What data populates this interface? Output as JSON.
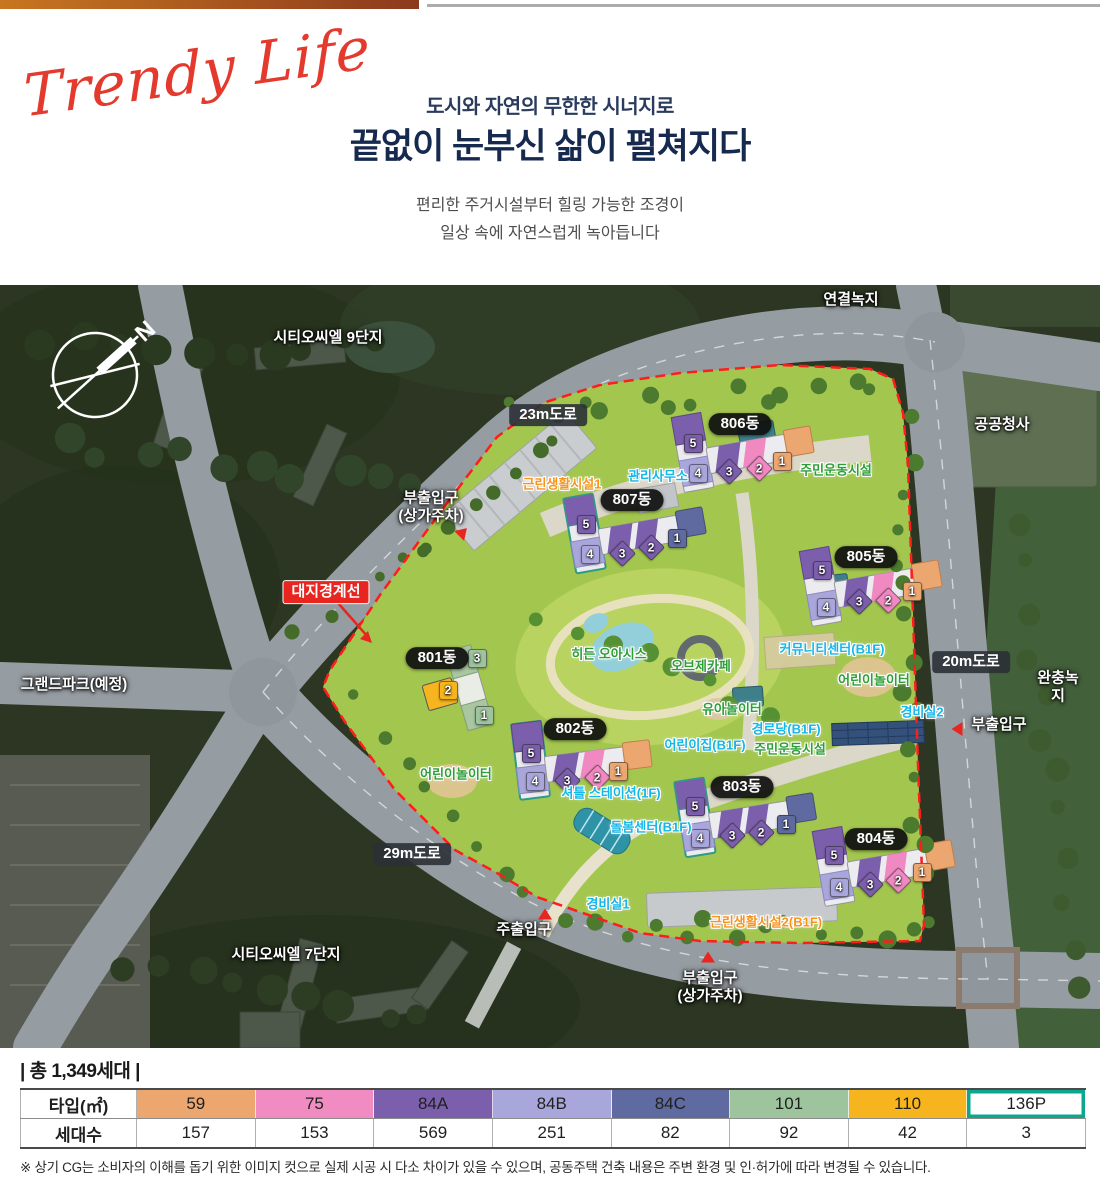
{
  "header": {
    "logo": "Trendy Life",
    "subtitle": "도시와 자연의 무한한 시너지로",
    "title": "끝없이 눈부신 삶이 펼쳐지다",
    "desc": "편리한 주거시설부터 힐링 가능한 조경이\n일상 속에 자연스럽게 녹아듭니다"
  },
  "map": {
    "compass_n": "N",
    "labels": [
      {
        "text": "연결녹지",
        "x": 851,
        "y": 15,
        "t": "w"
      },
      {
        "text": "시티오씨엘 9단지",
        "x": 328,
        "y": 53,
        "t": "w"
      },
      {
        "text": "공공청사",
        "x": 1002,
        "y": 140,
        "t": "w"
      },
      {
        "text": "완충녹지",
        "x": 1058,
        "y": 402,
        "t": "w"
      },
      {
        "text": "그랜드파크(예정)",
        "x": 74,
        "y": 400,
        "t": "w"
      },
      {
        "text": "시티오씨엘 7단지",
        "x": 286,
        "y": 670,
        "t": "w"
      },
      {
        "text": "부출입구\n(상가주차)",
        "x": 431,
        "y": 222,
        "t": "w"
      },
      {
        "text": "부출입구",
        "x": 999,
        "y": 440,
        "t": "w"
      },
      {
        "text": "부출입구\n(상가주차)",
        "x": 710,
        "y": 702,
        "t": "w"
      },
      {
        "text": "주출입구",
        "x": 524,
        "y": 645,
        "t": "w"
      },
      {
        "text": "23m도로",
        "x": 548,
        "y": 130,
        "t": "road"
      },
      {
        "text": "29m도로",
        "x": 412,
        "y": 569,
        "t": "road"
      },
      {
        "text": "20m도로",
        "x": 971,
        "y": 377,
        "t": "road"
      },
      {
        "text": "대지경계선",
        "x": 326,
        "y": 307,
        "t": "red"
      },
      {
        "text": "근린생활시설1",
        "x": 562,
        "y": 199,
        "t": "or"
      },
      {
        "text": "근린생활시설2(B1F)",
        "x": 766,
        "y": 637,
        "t": "or"
      },
      {
        "text": "관리사무소",
        "x": 658,
        "y": 191,
        "t": "cy"
      },
      {
        "text": "커뮤니티센터(B1F)",
        "x": 832,
        "y": 364,
        "t": "cy"
      },
      {
        "text": "경비실2",
        "x": 922,
        "y": 427,
        "t": "cy"
      },
      {
        "text": "경비실1",
        "x": 608,
        "y": 619,
        "t": "cy"
      },
      {
        "text": "경로당(B1F)",
        "x": 786,
        "y": 444,
        "t": "cy"
      },
      {
        "text": "어린이집(B1F)",
        "x": 705,
        "y": 460,
        "t": "cy"
      },
      {
        "text": "셔틀 스테이션(1F)",
        "x": 611,
        "y": 508,
        "t": "cy"
      },
      {
        "text": "돌봄센터(B1F)",
        "x": 651,
        "y": 542,
        "t": "cy"
      },
      {
        "text": "주민운동시설",
        "x": 836,
        "y": 185,
        "t": "gr"
      },
      {
        "text": "주민운동시설",
        "x": 790,
        "y": 464,
        "t": "gr"
      },
      {
        "text": "어린이놀이터",
        "x": 874,
        "y": 395,
        "t": "gr"
      },
      {
        "text": "어린이놀이터",
        "x": 456,
        "y": 489,
        "t": "gr"
      },
      {
        "text": "히든 오아시스",
        "x": 609,
        "y": 369,
        "t": "gr"
      },
      {
        "text": "오브제카페",
        "x": 701,
        "y": 381,
        "t": "gr"
      },
      {
        "text": "유아놀이터",
        "x": 732,
        "y": 424,
        "t": "gr"
      }
    ],
    "dong_pills": [
      {
        "text": "801동",
        "x": 437,
        "y": 373
      },
      {
        "text": "802동",
        "x": 575,
        "y": 444
      },
      {
        "text": "803동",
        "x": 742,
        "y": 502
      },
      {
        "text": "804동",
        "x": 876,
        "y": 554
      },
      {
        "text": "805동",
        "x": 866,
        "y": 272
      },
      {
        "text": "806동",
        "x": 740,
        "y": 139
      },
      {
        "text": "807동",
        "x": 632,
        "y": 215
      }
    ],
    "unit_badges": [
      {
        "b": "801",
        "n": "3",
        "x": 476,
        "y": 372,
        "c": "#9DC49C",
        "s": "s"
      },
      {
        "b": "801",
        "n": "2",
        "x": 447,
        "y": 404,
        "c": "#F6B51E",
        "s": "s"
      },
      {
        "b": "801",
        "n": "1",
        "x": 483,
        "y": 429,
        "c": "#9DC49C",
        "s": "s"
      },
      {
        "b": "802",
        "n": "5",
        "x": 530,
        "y": 467,
        "c": "#7C5FAC",
        "s": "s"
      },
      {
        "b": "802",
        "n": "4",
        "x": 534,
        "y": 495,
        "c": "#A9A6DB",
        "s": "s"
      },
      {
        "b": "802",
        "n": "3",
        "x": 566,
        "y": 494,
        "c": "#7C5FAC",
        "s": "d"
      },
      {
        "b": "802",
        "n": "2",
        "x": 596,
        "y": 491,
        "c": "#F089C2",
        "s": "d"
      },
      {
        "b": "802",
        "n": "1",
        "x": 617,
        "y": 485,
        "c": "#ECA771",
        "s": "s"
      },
      {
        "b": "803",
        "n": "5",
        "x": 694,
        "y": 520,
        "c": "#7C5FAC",
        "s": "s"
      },
      {
        "b": "803",
        "n": "4",
        "x": 699,
        "y": 552,
        "c": "#A9A6DB",
        "s": "s"
      },
      {
        "b": "803",
        "n": "3",
        "x": 731,
        "y": 549,
        "c": "#7C5FAC",
        "s": "d"
      },
      {
        "b": "803",
        "n": "2",
        "x": 760,
        "y": 546,
        "c": "#7C5FAC",
        "s": "d"
      },
      {
        "b": "803",
        "n": "1",
        "x": 785,
        "y": 538,
        "c": "#5F6BA0",
        "s": "s"
      },
      {
        "b": "804",
        "n": "5",
        "x": 833,
        "y": 569,
        "c": "#7C5FAC",
        "s": "s"
      },
      {
        "b": "804",
        "n": "4",
        "x": 838,
        "y": 601,
        "c": "#A9A6DB",
        "s": "s"
      },
      {
        "b": "804",
        "n": "3",
        "x": 869,
        "y": 598,
        "c": "#7C5FAC",
        "s": "d"
      },
      {
        "b": "804",
        "n": "2",
        "x": 897,
        "y": 594,
        "c": "#F089C2",
        "s": "d"
      },
      {
        "b": "804",
        "n": "1",
        "x": 921,
        "y": 586,
        "c": "#ECA771",
        "s": "s"
      },
      {
        "b": "805",
        "n": "5",
        "x": 821,
        "y": 284,
        "c": "#7C5FAC",
        "s": "s"
      },
      {
        "b": "805",
        "n": "4",
        "x": 825,
        "y": 321,
        "c": "#A9A6DB",
        "s": "s"
      },
      {
        "b": "805",
        "n": "3",
        "x": 858,
        "y": 315,
        "c": "#7C5FAC",
        "s": "d"
      },
      {
        "b": "805",
        "n": "2",
        "x": 887,
        "y": 314,
        "c": "#F089C2",
        "s": "d"
      },
      {
        "b": "805",
        "n": "1",
        "x": 911,
        "y": 305,
        "c": "#ECA771",
        "s": "s"
      },
      {
        "b": "806",
        "n": "5",
        "x": 692,
        "y": 157,
        "c": "#7C5FAC",
        "s": "s"
      },
      {
        "b": "806",
        "n": "4",
        "x": 697,
        "y": 187,
        "c": "#A9A6DB",
        "s": "s"
      },
      {
        "b": "806",
        "n": "3",
        "x": 728,
        "y": 185,
        "c": "#7C5FAC",
        "s": "d"
      },
      {
        "b": "806",
        "n": "2",
        "x": 758,
        "y": 182,
        "c": "#F089C2",
        "s": "d"
      },
      {
        "b": "806",
        "n": "1",
        "x": 781,
        "y": 175,
        "c": "#ECA771",
        "s": "s"
      },
      {
        "b": "807",
        "n": "5",
        "x": 585,
        "y": 238,
        "c": "#7C5FAC",
        "s": "s"
      },
      {
        "b": "807",
        "n": "4",
        "x": 589,
        "y": 268,
        "c": "#A9A6DB",
        "s": "s"
      },
      {
        "b": "807",
        "n": "3",
        "x": 621,
        "y": 267,
        "c": "#7C5FAC",
        "s": "d"
      },
      {
        "b": "807",
        "n": "2",
        "x": 650,
        "y": 261,
        "c": "#7C5FAC",
        "s": "d"
      },
      {
        "b": "807",
        "n": "1",
        "x": 676,
        "y": 252,
        "c": "#5F6BA0",
        "s": "s"
      }
    ],
    "arrows": [
      {
        "x": 545,
        "y": 629,
        "d": "up"
      },
      {
        "x": 708,
        "y": 672,
        "d": "up"
      },
      {
        "x": 957,
        "y": 444,
        "d": "left"
      },
      {
        "x": 463,
        "y": 247,
        "d": "ne"
      }
    ]
  },
  "summary": {
    "total": "| 총 1,349세대 |"
  },
  "table": {
    "type_header": "타입(㎡)",
    "count_header": "세대수",
    "columns": [
      {
        "type": "59",
        "bg": "#ECA771",
        "count": "157"
      },
      {
        "type": "75",
        "bg": "#F08CC2",
        "count": "153"
      },
      {
        "type": "84A",
        "bg": "#7C5FAC",
        "count": "569"
      },
      {
        "type": "84B",
        "bg": "#A9A6DB",
        "count": "251"
      },
      {
        "type": "84C",
        "bg": "#5F6BA0",
        "count": "82"
      },
      {
        "type": "101",
        "bg": "#9DC49C",
        "count": "92"
      },
      {
        "type": "110",
        "bg": "#F6B51E",
        "count": "42"
      },
      {
        "type": "136P",
        "bg": "#FFFFFF",
        "count": "3",
        "border": "#0BA78E"
      }
    ]
  },
  "disclaimer": "※ 상기 CG는 소비자의 이해를 돕기 위한 이미지 컷으로 실제 시공 시 다소 차이가 있을 수 있으며, 공동주택 건축 내용은 주변 환경 및 인·허가에 따라 변경될 수 있습니다."
}
